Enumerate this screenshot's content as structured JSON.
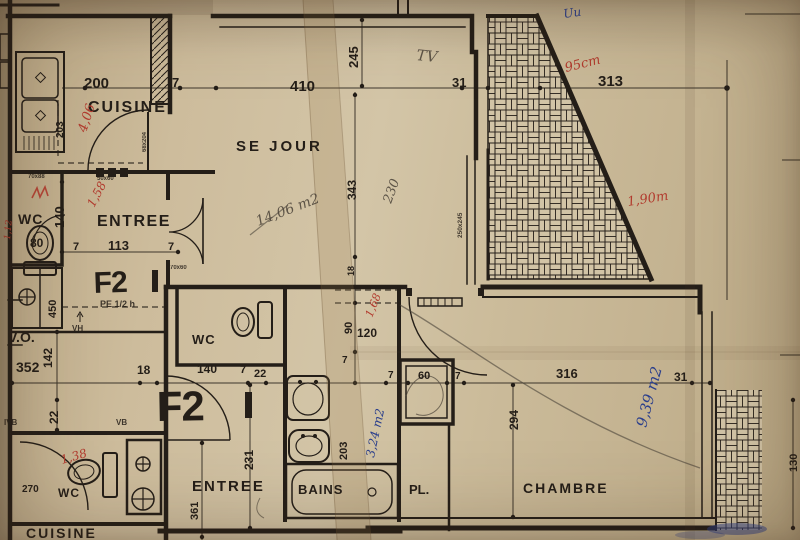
{
  "rooms": {
    "cuisine_top": "CUISINE",
    "sejour": "SE JOUR",
    "entree_top": "ENTREE",
    "wc_top": "WC",
    "wc_mid": "WC",
    "entree_bottom": "ENTREE",
    "bains": "BAINS",
    "pl": "PL.",
    "chambre": "CHAMBRE",
    "wc_bottom": "WC",
    "cuisine_bottom": "CUISINE",
    "vo": "V.O."
  },
  "stamps": {
    "f2_upper": "F2",
    "f2_lower": "F2"
  },
  "dims": {
    "d200": "200",
    "d7a": "7",
    "d410": "410",
    "d31a": "31",
    "d313": "313",
    "d245": "245",
    "d343": "343",
    "d140a": "140",
    "d80": "80",
    "d7b": "7",
    "d113": "113",
    "d7c": "7",
    "d450": "450",
    "d352": "352",
    "d142": "142",
    "d18a": "18",
    "d22a": "22",
    "d140b": "140",
    "d7d": "7",
    "d22b": "22",
    "d231": "231",
    "d361": "361",
    "d18b": "18",
    "d90": "90",
    "d120": "120",
    "d7e": "7",
    "d60a": "60",
    "d7f": "7",
    "d7g": "7",
    "d316": "316",
    "d31b": "31",
    "d294": "294",
    "d203a": "203",
    "d203b": "203",
    "d270": "270",
    "d130": "130"
  },
  "red": {
    "a406": "4,06",
    "a158": "1,58",
    "a112": "1,12",
    "a95": "95cm",
    "a190": "1,90m",
    "a168": "1,68",
    "a138": "1,38"
  },
  "pencil": {
    "tv": "TV",
    "sejour_area": "14,06 m2",
    "a230": "230"
  },
  "blue": {
    "scribble": "Uu",
    "chambre_area": "9,39 m2",
    "bains_area": "3,24 m2"
  },
  "micro": {
    "pe": "PE 1/2 h",
    "vh": "VH",
    "vb": "VB",
    "ivb": "IVB",
    "m1": "70x88",
    "m2": "50x60",
    "m3": "68x204",
    "m4": "250x245",
    "m5": "70x60"
  },
  "colors": {
    "ink": "#241e18",
    "red": "#b23b2e",
    "blue": "#2b3f8c",
    "pencil": "#4a4238",
    "paper": "#c9b897"
  }
}
